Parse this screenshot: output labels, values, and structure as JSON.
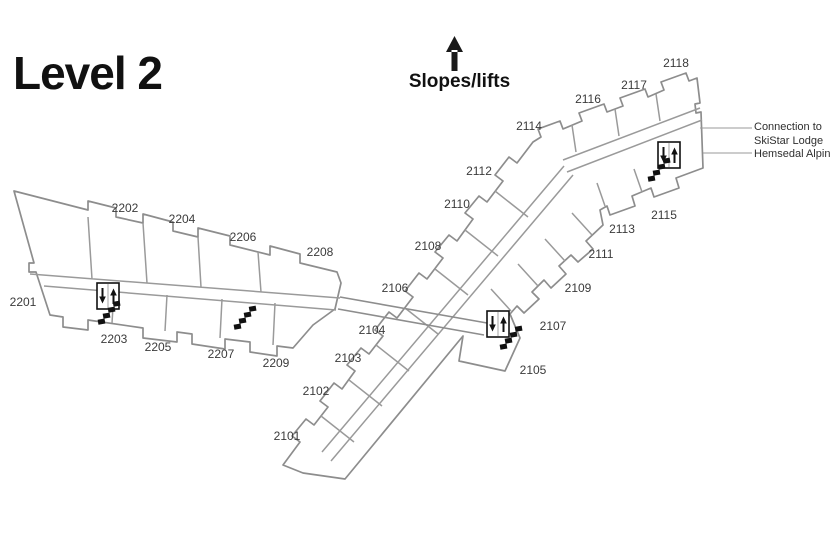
{
  "title": "Level 2",
  "slopes": {
    "label": "Slopes/lifts"
  },
  "connection_note": {
    "lines": [
      "Connection to",
      "SkiStar Lodge",
      "Hemsedal Alpin"
    ]
  },
  "colors": {
    "wall": "#8d8d8d",
    "interior_wall": "#9a9a9a",
    "label": "#3b3b3b",
    "ink": "#111111",
    "background": "#ffffff"
  },
  "map": {
    "label_font_size": 12,
    "rooms": [
      {
        "id": "2201",
        "x": 23,
        "y": 302
      },
      {
        "id": "2202",
        "x": 125,
        "y": 208
      },
      {
        "id": "2203",
        "x": 114,
        "y": 339
      },
      {
        "id": "2204",
        "x": 182,
        "y": 219
      },
      {
        "id": "2205",
        "x": 158,
        "y": 347
      },
      {
        "id": "2206",
        "x": 243,
        "y": 237
      },
      {
        "id": "2207",
        "x": 221,
        "y": 354
      },
      {
        "id": "2208",
        "x": 320,
        "y": 252
      },
      {
        "id": "2209",
        "x": 276,
        "y": 363
      },
      {
        "id": "2101",
        "x": 287,
        "y": 436
      },
      {
        "id": "2102",
        "x": 316,
        "y": 391
      },
      {
        "id": "2103",
        "x": 348,
        "y": 358
      },
      {
        "id": "2104",
        "x": 372,
        "y": 330
      },
      {
        "id": "2105",
        "x": 533,
        "y": 370
      },
      {
        "id": "2106",
        "x": 395,
        "y": 288
      },
      {
        "id": "2107",
        "x": 553,
        "y": 326
      },
      {
        "id": "2108",
        "x": 428,
        "y": 246
      },
      {
        "id": "2109",
        "x": 578,
        "y": 288
      },
      {
        "id": "2110",
        "x": 457,
        "y": 204
      },
      {
        "id": "2111",
        "x": 601,
        "y": 254
      },
      {
        "id": "2112",
        "x": 479,
        "y": 171
      },
      {
        "id": "2113",
        "x": 622,
        "y": 229
      },
      {
        "id": "2114",
        "x": 529,
        "y": 126
      },
      {
        "id": "2115",
        "x": 664,
        "y": 215
      },
      {
        "id": "2116",
        "x": 588,
        "y": 99
      },
      {
        "id": "2117",
        "x": 634,
        "y": 85
      },
      {
        "id": "2118",
        "x": 676,
        "y": 63
      }
    ],
    "elevators": [
      {
        "x": 97,
        "y": 283
      },
      {
        "x": 487,
        "y": 311
      },
      {
        "x": 658,
        "y": 142
      }
    ],
    "stairs": [
      {
        "x": 95,
        "y": 305,
        "angle": -10
      },
      {
        "x": 231,
        "y": 310,
        "angle": -10
      },
      {
        "x": 497,
        "y": 330,
        "angle": -10
      },
      {
        "x": 645,
        "y": 162,
        "angle": -10
      }
    ]
  }
}
